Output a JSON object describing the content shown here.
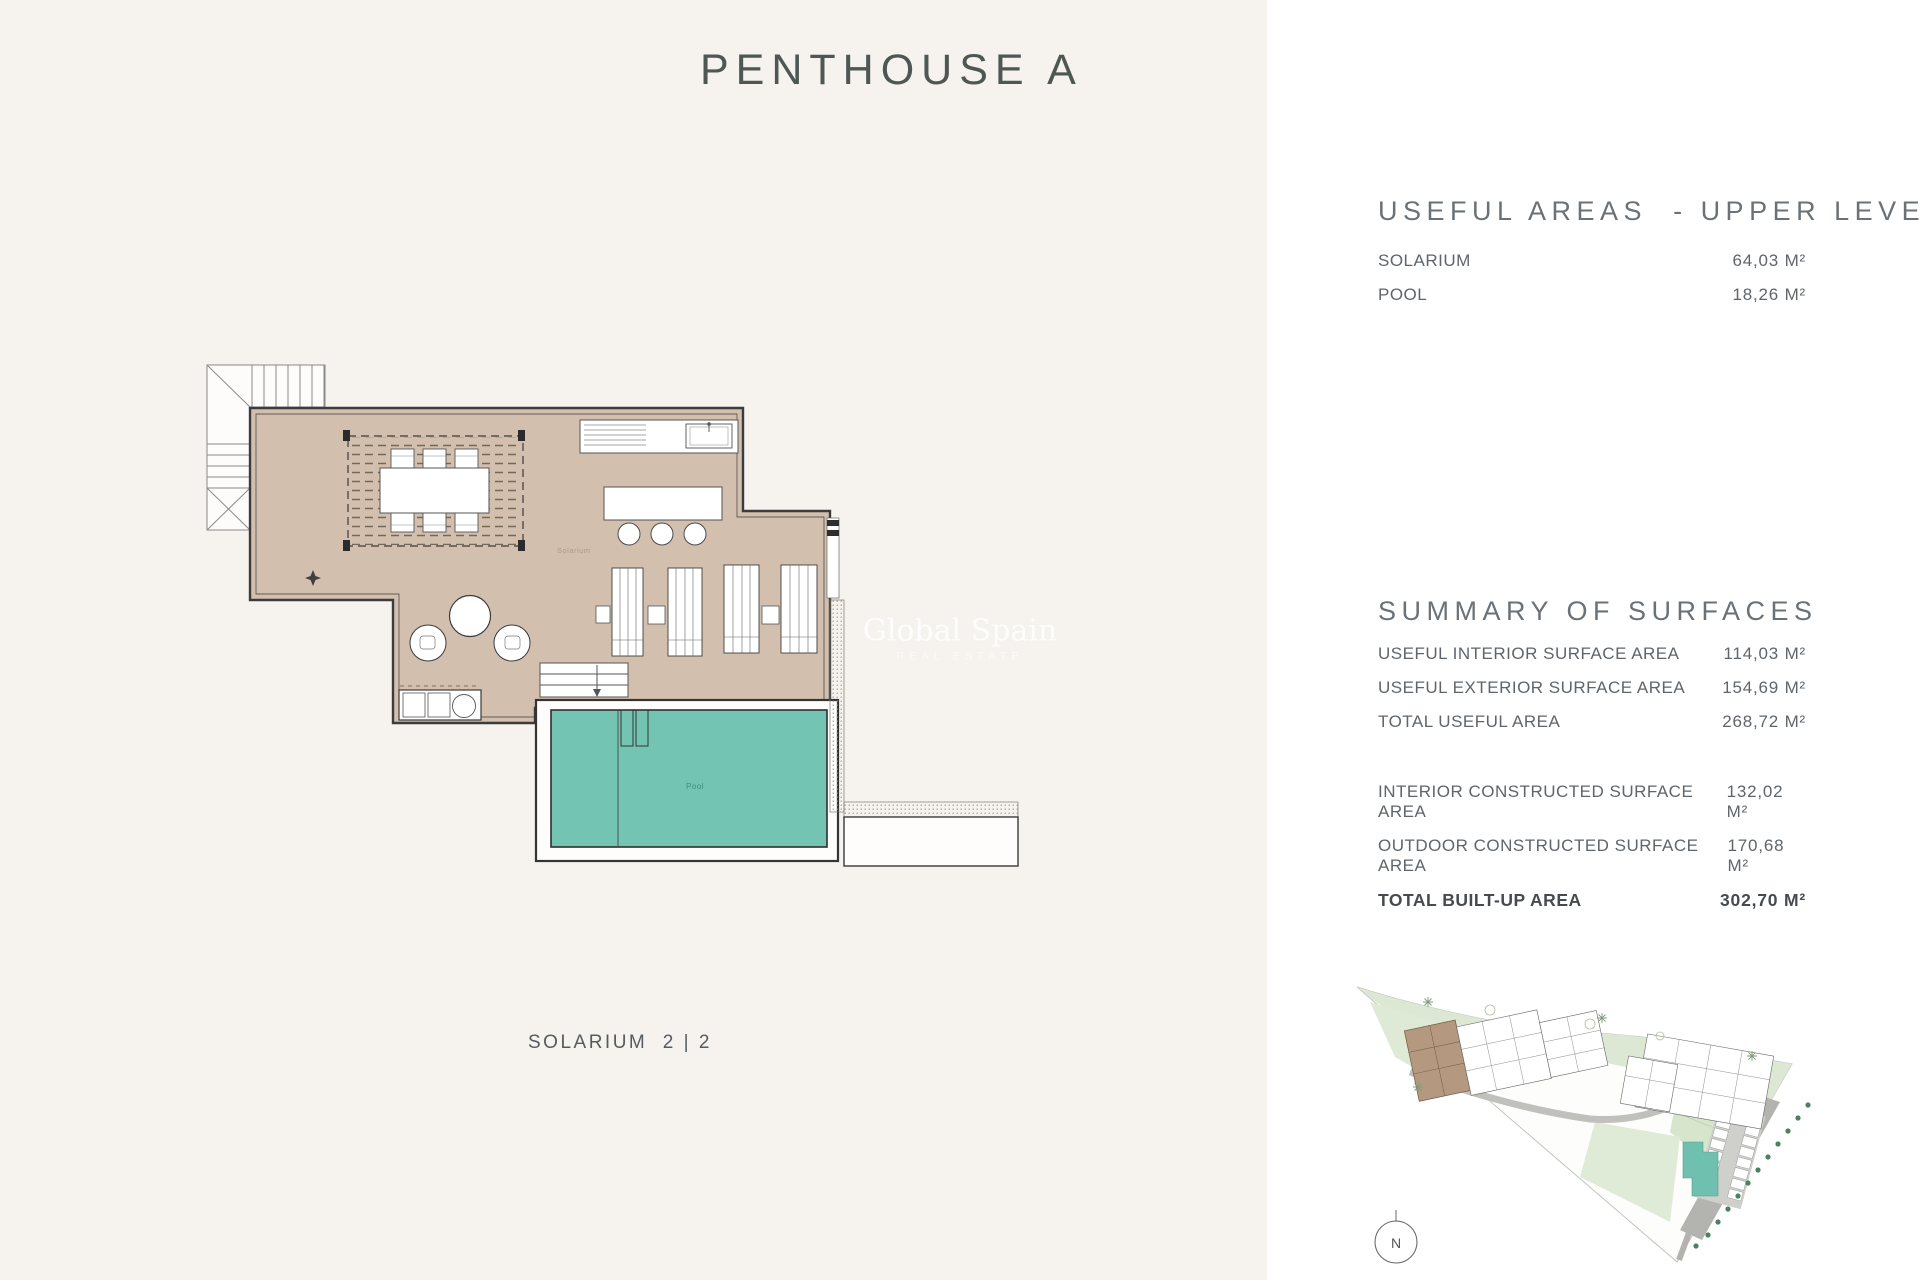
{
  "page": {
    "title": "PENTHOUSE A",
    "plan_caption": "SOLARIUM  2 | 2",
    "background_color": "#f6f2ed",
    "panel_color": "#ffffff"
  },
  "watermark": {
    "line1": "Global Spain",
    "line2": "REAL ESTATE"
  },
  "useful_areas": {
    "heading": "USEFUL AREAS  - UPPER LEVEL",
    "rows": [
      {
        "label": "SOLARIUM",
        "value": "64,03 M²"
      },
      {
        "label": "POOL",
        "value": "18,26 M²"
      }
    ]
  },
  "summary": {
    "heading": "SUMMARY OF SURFACES",
    "rows": [
      {
        "label": "USEFUL INTERIOR SURFACE AREA",
        "value": "114,03 M²"
      },
      {
        "label": "USEFUL EXTERIOR SURFACE AREA",
        "value": "154,69 M²"
      },
      {
        "label": "TOTAL USEFUL AREA",
        "value": "268,72 M²"
      },
      {
        "label": "INTERIOR CONSTRUCTED SURFACE AREA",
        "value": "132,02 M²"
      },
      {
        "label": "OUTDOOR CONSTRUCTED SURFACE AREA",
        "value": "170,68 M²"
      }
    ],
    "total": {
      "label": "TOTAL BUILT-UP AREA",
      "value": "302,70 M²"
    }
  },
  "floorplan": {
    "room_label": "Solarium",
    "pool_label": "Pool",
    "colors": {
      "terrace": "#d3bfae",
      "pool": "#73c4b2",
      "outline": "#3c3c3c",
      "deck": "#fefdfb"
    }
  },
  "siteplan": {
    "compass_label": "N",
    "colors": {
      "green": "#dce8d3",
      "highlight_building": "#b59880",
      "community_pool": "#6fc0ae",
      "road": "#b3b3af"
    }
  }
}
